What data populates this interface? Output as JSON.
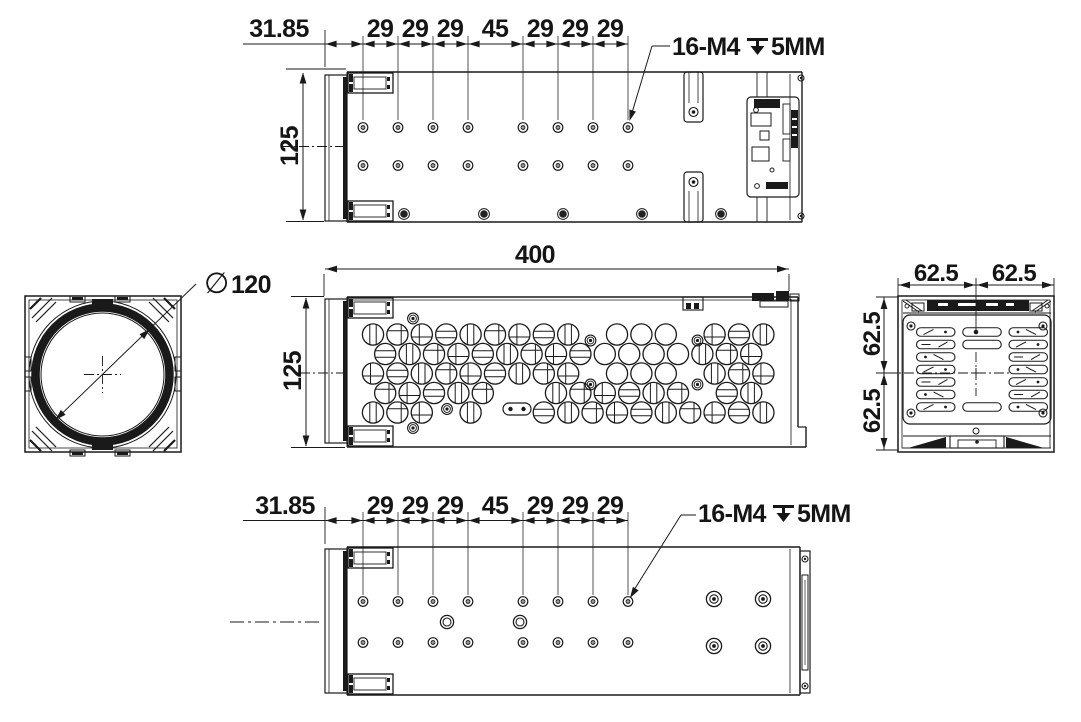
{
  "drawing": {
    "background": "#ffffff",
    "line_color": "#1a1a1a"
  },
  "top_view": {
    "offset_dim": "31.85",
    "pitch_dims": [
      "29",
      "29",
      "29",
      "45",
      "29",
      "29",
      "29"
    ],
    "height_dim": "125",
    "callout": {
      "count_thread": "16-M4",
      "depth_value": "5MM"
    }
  },
  "front_view": {
    "diameter_symbol": "∅",
    "diameter_value": "120"
  },
  "side_view": {
    "length_dim": "400",
    "height_dim": "125"
  },
  "rear_view": {
    "top_dims": [
      "62.5",
      "62.5"
    ],
    "side_dims": [
      "62.5",
      "62.5"
    ]
  },
  "bottom_view": {
    "offset_dim": "31.85",
    "pitch_dims": [
      "29",
      "29",
      "29",
      "45",
      "29",
      "29",
      "29"
    ],
    "callout": {
      "count_thread": "16-M4",
      "depth_value": "5MM"
    }
  }
}
